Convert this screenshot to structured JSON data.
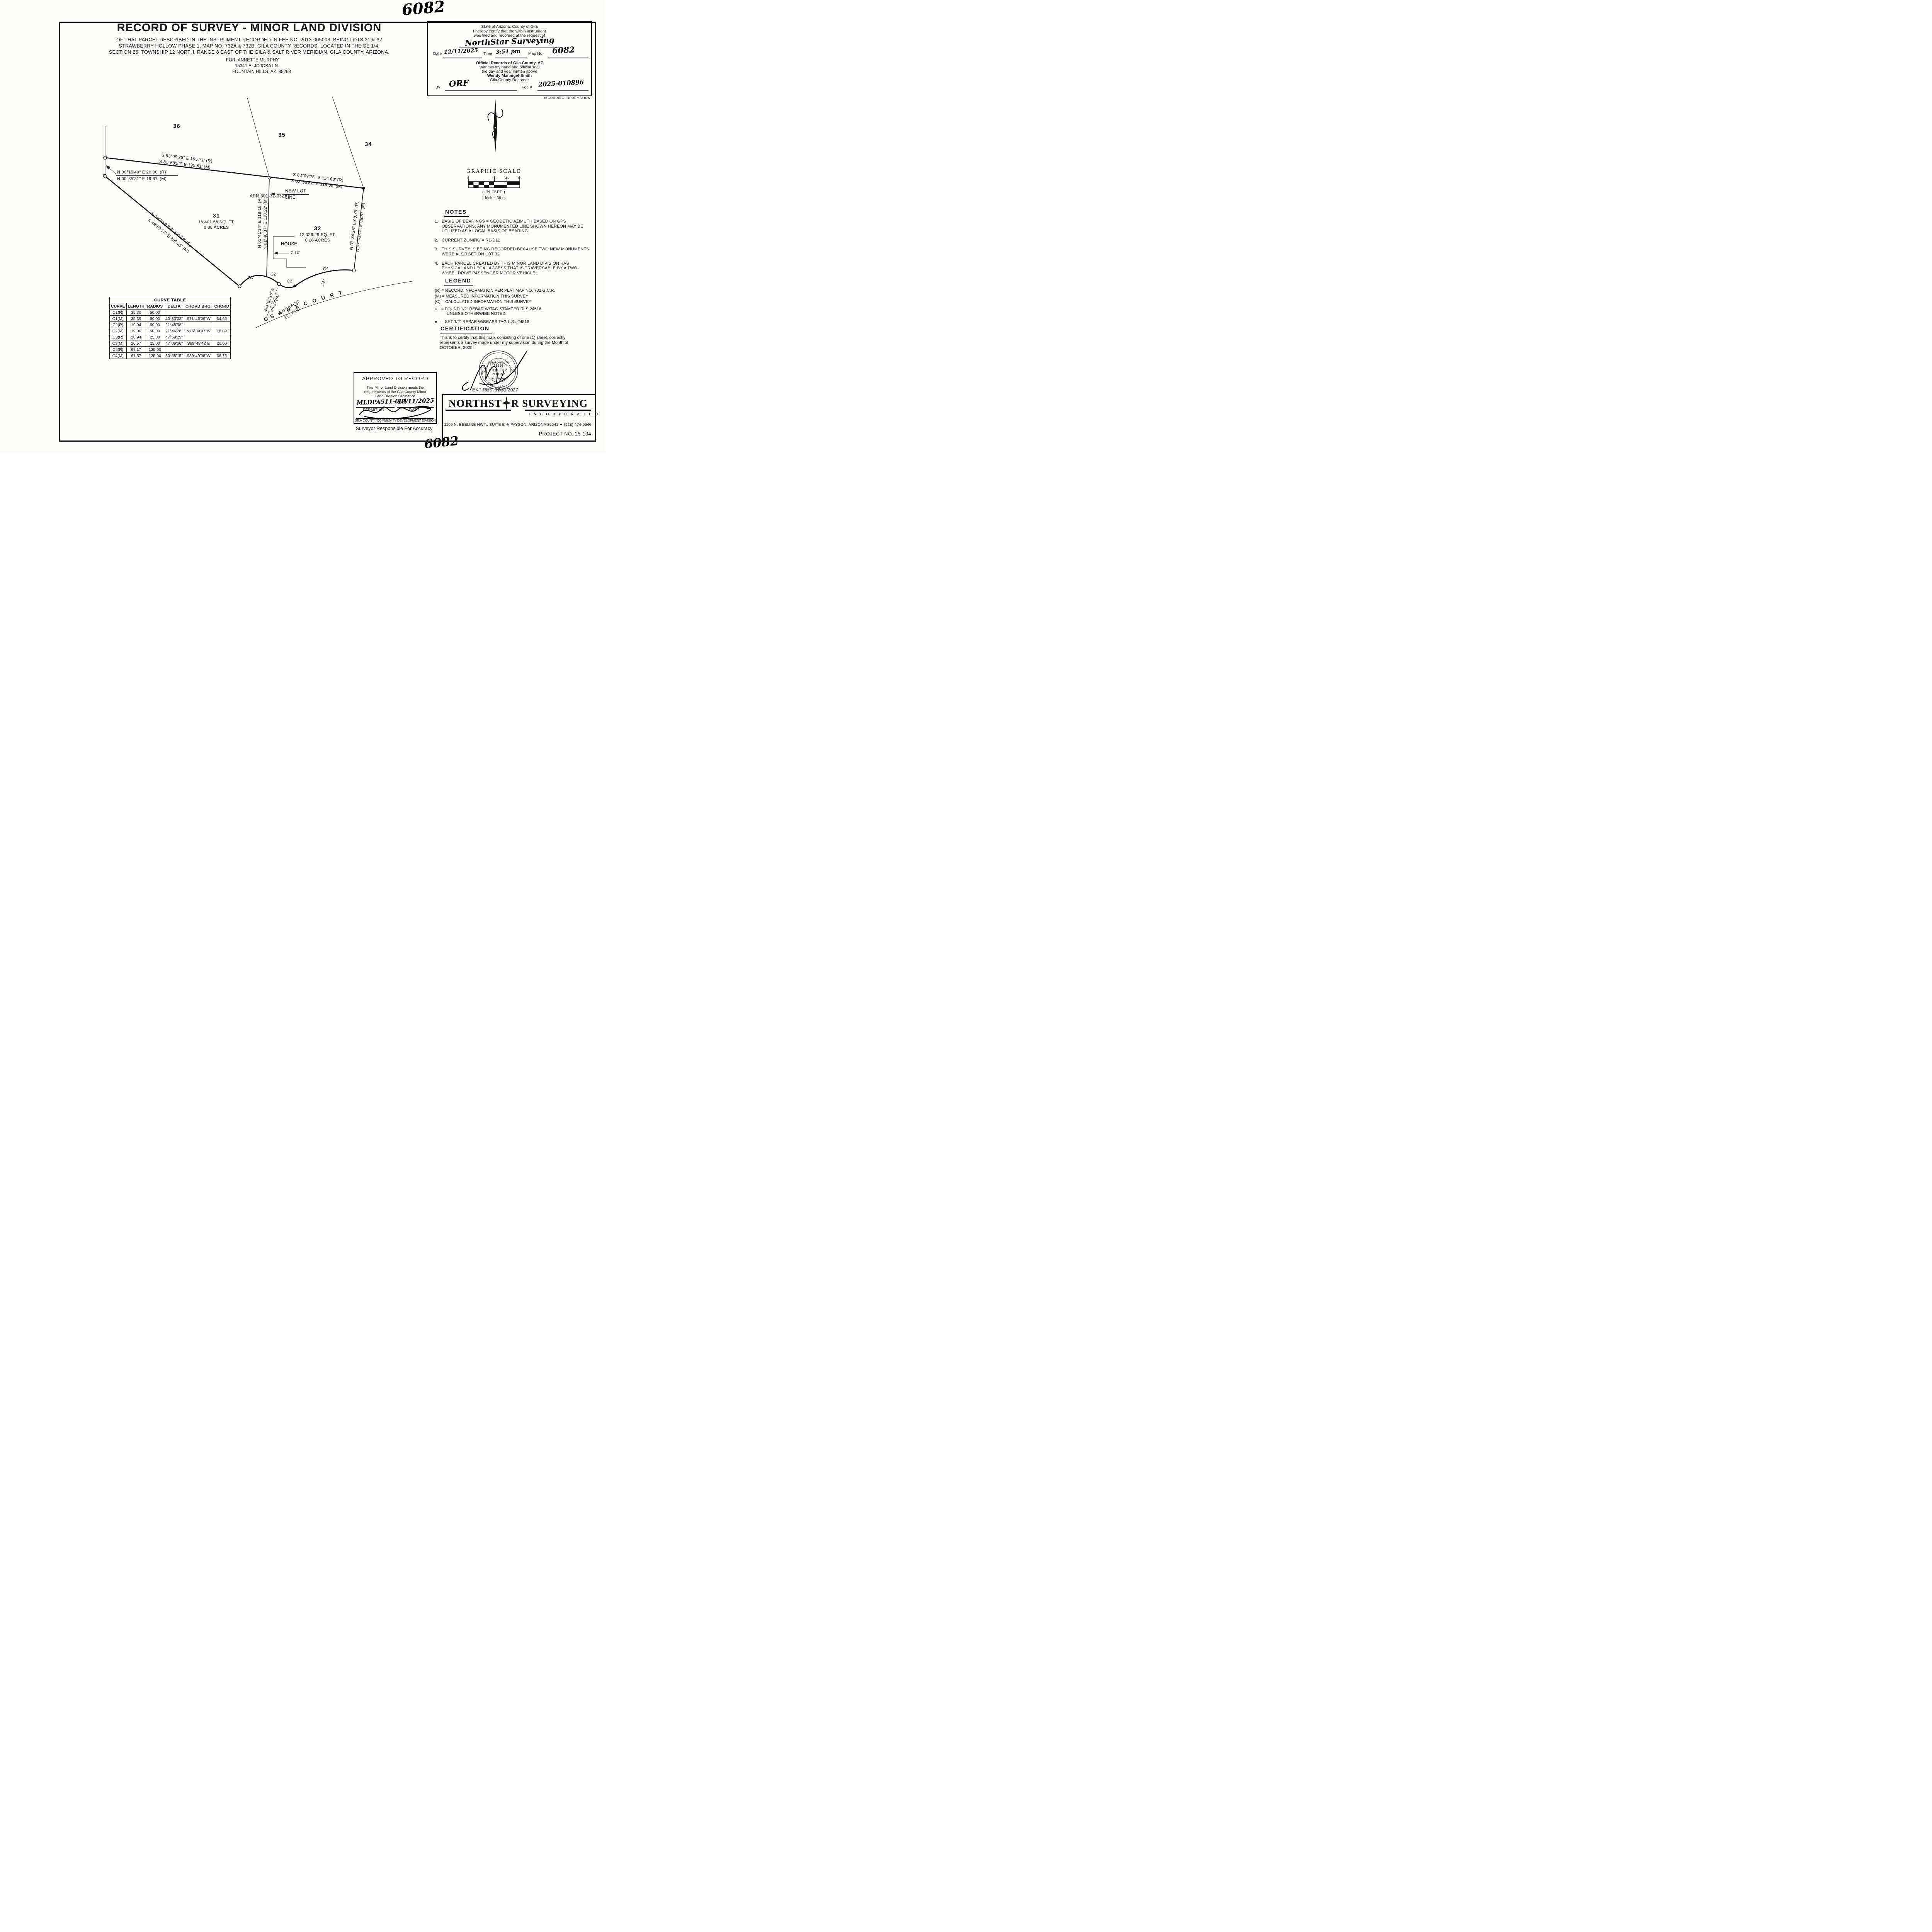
{
  "sheet": {
    "handwritten_number_top": "6082",
    "handwritten_number_bottom": "6082",
    "recording_information_label": "RECORDING INFORMATION"
  },
  "title_block": {
    "title": "RECORD OF SURVEY - MINOR LAND DIVISION",
    "description_line1": "OF THAT PARCEL DESCRIBED IN THE INSTRUMENT RECORDED IN FEE NO. 2013-005008, BEING LOTS 31 & 32",
    "description_line2": "STRAWBERRY HOLLOW PHASE 1, MAP NO. 732A & 732B, GILA COUNTY RECORDS. LOCATED IN THE SE 1/4,",
    "description_line3": "SECTION 26, TOWNSHIP 12 NORTH, RANGE 8 EAST OF THE GILA & SALT RIVER MERIDIAN, GILA COUNTY, ARIZONA.",
    "for_line1": "FOR: ANNETTE MURPHY",
    "for_line2": "15341 E. JOJOBA LN.",
    "for_line3": "FOUNTAIN HILLS, AZ. 85268"
  },
  "recording_box": {
    "line1": "State of Arizona, County of Gila",
    "line2": "I hereby certify that the within instrument",
    "line3": "was filed and recorded at the request of",
    "request_of_value": "NorthStar Surveying",
    "date_label": "Date",
    "date_value": "12/11/2025",
    "time_label": "Time",
    "time_value": "3:51 pm",
    "map_no_label": "Map No.",
    "map_no_value": "6082",
    "official_line1": "Official Records of Gila County, AZ",
    "official_line2": "Witness my hand and official seal",
    "official_line3": "the day and year written above",
    "recorder_name": "Wendy Mannigel-Smith",
    "recorder_title": "Gila County Recorder",
    "by_label": "By",
    "by_value": "ORF",
    "fee_label": "Fee #",
    "fee_value": "2025-010896"
  },
  "graphic_scale": {
    "title": "GRAPHIC SCALE",
    "tick_0": "0",
    "tick_30": "30",
    "tick_45": "45",
    "tick_60": "60",
    "units_note": "( IN FEET )",
    "ratio_note": "1 inch = 30 ft."
  },
  "notes": {
    "heading": "NOTES",
    "items": [
      "BASIS OF BEARINGS = GEODETIC AZIMUTH BASED ON GPS OBSERVATIONS, ANY MONUMENTED LINE SHOWN HEREON MAY BE UTILIZED AS A LOCAL BASIS OF BEARING.",
      "CURRENT ZONING = R1-D12",
      "THIS SURVEY IS BEING RECORDED BECAUSE TWO NEW MONUMENTS WERE ALSO SET ON LOT 32.",
      "EACH PARCEL CREATED BY THIS MINOR LAND DIVISION HAS PHYSICAL AND LEGAL ACCESS THAT IS TRAVERSABLE BY A TWO-WHEEL DRIVE PASSENGER MOTOR VEHICLE."
    ]
  },
  "legend": {
    "heading": "LEGEND",
    "r_item": "(R) = RECORD INFORMATION PER PLAT MAP NO. 732 G.C.R.",
    "m_item": "(M) = MEASURED INFORMATION THIS SURVEY",
    "c_item": "(C) = CALCULATED INFORMATION THIS SURVEY",
    "found_symbol": "○",
    "found_line1": "=  FOUND 1/2\" REBAR W/TAG STAMPED RLS 24516,",
    "found_line2": "UNLESS OTHERWISE NOTED",
    "set_symbol": "●",
    "set_item": "=  SET 1/2\" REBAR W/BRASS TAG L.S.#24516"
  },
  "certification": {
    "heading": "CERTIFICATION",
    "body_line1": "This is to certify that this map, consisting of one (1) sheet, correctly",
    "body_line2": "represents a survey made under my supervision during the Month of",
    "body_line3": "OCTOBER, 2025.",
    "expires": "EXPIRES: 12/31/2027",
    "seal": {
      "arc_top": "REGISTERED LAND SURVEYOR",
      "arc_bottom": "ARIZONA, U.S.A.",
      "cert_no_label": "CERTIFICATE NO.",
      "cert_no": "23956",
      "name_line1": "STEPHEN R.",
      "name_line2": "PERHAM",
      "date_signed": "Date Signed"
    }
  },
  "approved_box": {
    "title": "APPROVED TO RECORD",
    "body_line1": "This Minor Land Division meets the",
    "body_line2": "requirements of the Gila County Minor",
    "body_line3": "Land Division Ordinance",
    "permit_value": "MLDPA511-001",
    "date_value": "12/11/2025",
    "permit_label": "PERMIT NO.",
    "date_label": "DATE",
    "division_line": "GILA COUNTY COMMUNITY DEVELOPMENT DIVISION",
    "below_note": "Surveyor Responsible For Accuracy"
  },
  "footer": {
    "company_part1": "NORTHST",
    "company_part2": "R SURVEYING",
    "incorporated": "I N C O R P O R A T E D",
    "address": "1100 N. BEELINE HWY., SUITE B ✦ PAYSON, ARIZONA 85541 ✦ (928) 474-9646",
    "project_no": "PROJECT NO. 25-134"
  },
  "curve_table": {
    "title": "CURVE TABLE",
    "headers": [
      "CURVE",
      "LENGTH",
      "RADIUS",
      "DELTA",
      "CHORD BRG.",
      "CHORD"
    ],
    "rows": [
      [
        "C1(R)",
        "35.30",
        "50.00",
        "",
        "",
        ""
      ],
      [
        "C1(M)",
        "35.39",
        "50.00",
        "40°33'02\"",
        "S71°46'06\"W",
        "34.65"
      ],
      [
        "C2(R)",
        "19.04",
        "50.00",
        "21°48'58\"",
        "",
        ""
      ],
      [
        "C2(M)",
        "19.00",
        "50.00",
        "21°46'28\"",
        "N76°30'07\"W",
        "18.89"
      ],
      [
        "C3(R)",
        "20.94",
        "25.00",
        "47°59'25\"",
        "",
        ""
      ],
      [
        "C3(M)",
        "20.57",
        "25.00",
        "47°09'06\"",
        "S89°48'42\"E",
        "20.00"
      ],
      [
        "C4(R)",
        "67.17",
        "125.00",
        "",
        "",
        ""
      ],
      [
        "C4(M)",
        "67.57",
        "125.00",
        "30°58'15\"",
        "S80°49'08\"W",
        "66.75"
      ]
    ]
  },
  "survey": {
    "apn": "APN 301-71-032A",
    "section_36": "36",
    "section_35": "35",
    "section_34": "34",
    "street_name": "S A G E   C O U R T",
    "lot31_number": "31",
    "lot31_sqft": "16,401.58 SQ. FT.",
    "lot31_acres": "0.38 ACRES",
    "lot32_number": "32",
    "lot32_sqft": "12,026.29 SQ. FT.",
    "lot32_acres": "0.28 ACRES",
    "north_top_r": "S 83°09'25\" E 195.71' (R)",
    "north_top_m": "S 82°58'52\" E 195.61' (M)",
    "north_right_r": "S 83°09'25\" E 114.68' (R)",
    "north_right_m": "S 82°58'52\" E 114.68' (M)",
    "west_tie_r": "N 00°15'40\" E 20.00' (R)",
    "west_tie_m": "N 00°35'21\" E 19.97' (M)",
    "sw_r": "S 50°03'20\" E 206.28' (R)",
    "sw_m": "S 49°52'14\" E 206.25' (M)",
    "newlot_r": "N 01°41'14\" E 118.18' (R)",
    "newlot_m": "N 01°48'37\" E 118.22' (M)",
    "east_r": "N 07°34'25\" E 98.79' (R)",
    "east_m": "N 07°43'47\" E 98.87' (M)",
    "new_lot_label_1": "NEW LOT",
    "new_lot_label_2": "LINE",
    "house_label": "HOUSE",
    "house_offset": "7.10'",
    "curve_c1": "C1",
    "curve_c2": "C2",
    "curve_c3": "C3",
    "curve_c4": "C4",
    "tie_brg": "S24°05'16\"W",
    "tie_dist": "49.57'(M)",
    "cl_brg": "N65°18'46\"E",
    "cl_dist": "55.38'(R)",
    "road_width": "25'"
  }
}
